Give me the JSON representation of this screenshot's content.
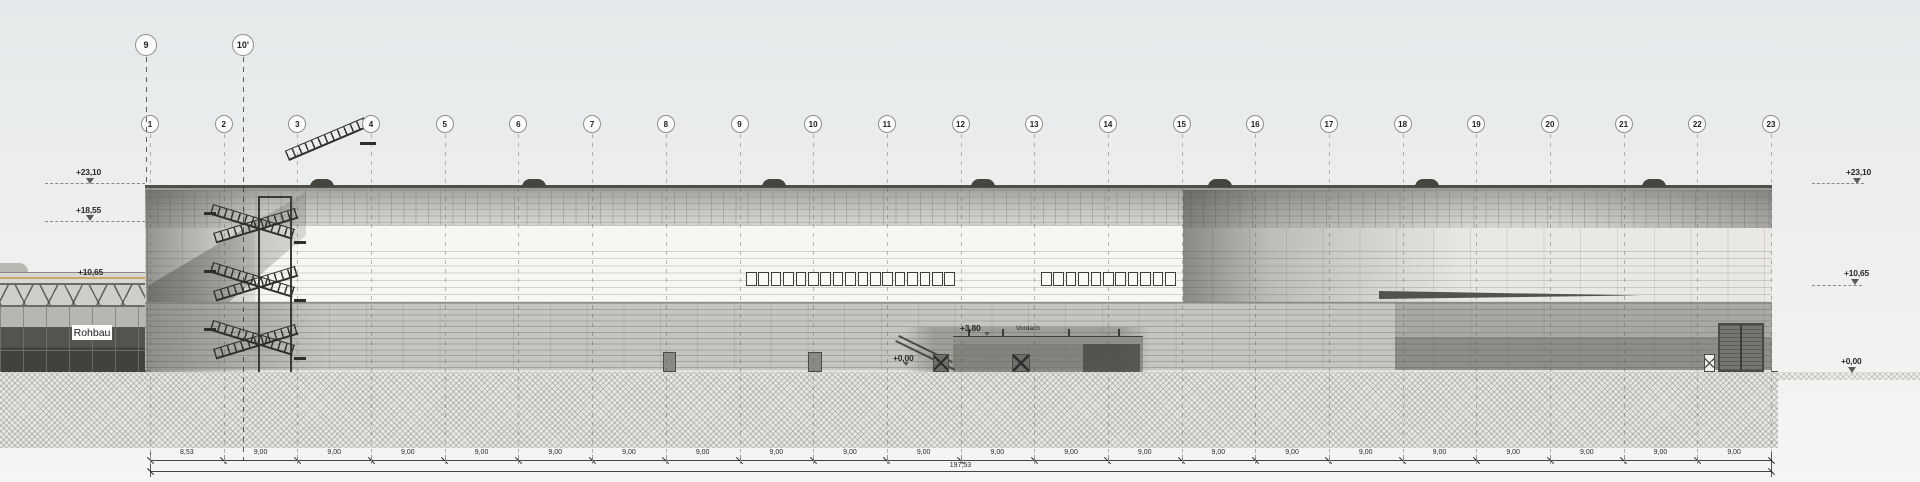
{
  "drawing": {
    "type": "architectural-elevation"
  },
  "colors": {
    "accent_magenta": "#a85aa8",
    "facade_white": "#f6f5f2",
    "facade_gray": "#c2c1bd",
    "line_dark": "#4a4a46",
    "ground_hatch": "#bcbcb8"
  },
  "grid": {
    "top_axes": [
      {
        "label": "9"
      },
      {
        "label": "10'"
      }
    ],
    "axes": [
      "1",
      "2",
      "3",
      "4",
      "5",
      "6",
      "7",
      "8",
      "9",
      "10",
      "11",
      "12",
      "13",
      "14",
      "15",
      "16",
      "17",
      "18",
      "19",
      "20",
      "21",
      "22",
      "23"
    ]
  },
  "levels": {
    "left": [
      "+23,10",
      "+18,55"
    ],
    "left_building": "+10,65",
    "right": [
      "+23,10",
      "+10,65",
      "+0,00"
    ],
    "middle": {
      "canopy_top": "+3,80",
      "canopy_label": "Vordach",
      "ground": "+0,00"
    }
  },
  "labels": {
    "rohbau": "Rohbau"
  },
  "dimensions": {
    "segments": [
      "8,53",
      "9,00",
      "9,00",
      "9,00",
      "9,00",
      "9,00",
      "9,00",
      "9,00",
      "9,00",
      "9,00",
      "9,00",
      "9,00",
      "9,00",
      "9,00",
      "9,00",
      "9,00",
      "9,00",
      "9,00",
      "9,00",
      "9,00",
      "9,00",
      "9,00"
    ],
    "total": "197,53"
  }
}
